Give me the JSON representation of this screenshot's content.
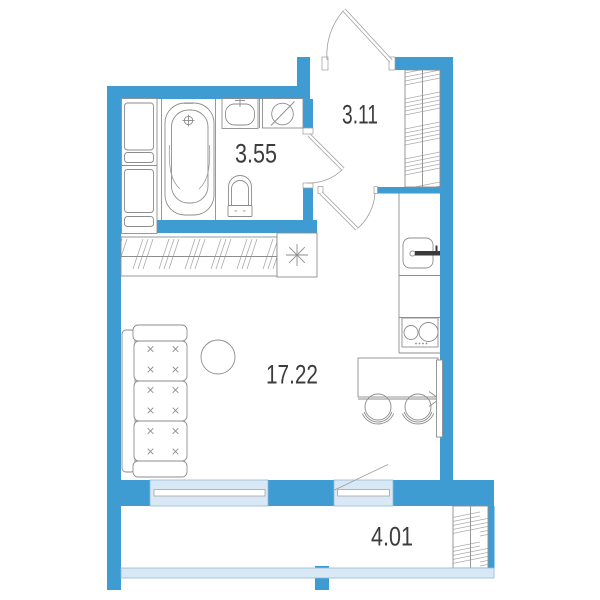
{
  "floor_plan": {
    "rooms": [
      {
        "name": "bathroom",
        "area_label": "3.55"
      },
      {
        "name": "hallway",
        "area_label": "3.11"
      },
      {
        "name": "living-room",
        "area_label": "17.22"
      },
      {
        "name": "balcony",
        "area_label": "4.01"
      }
    ],
    "colors": {
      "wall": "#3E9CD3",
      "glazing": "#D9E8F5",
      "outline": "#8D8D8D",
      "label_text": "#3C3C3C",
      "background": "#FFFFFF"
    },
    "fixtures": [
      "wardrobe",
      "bathtub",
      "bathroom-sink",
      "washing-machine",
      "toilet",
      "entrance-door",
      "bathroom-door",
      "living-room-door",
      "hall-closet",
      "kitchen-counter",
      "kitchen-sink",
      "cooktop",
      "dining-table",
      "chair",
      "radiator",
      "sofa",
      "round-table",
      "window",
      "balcony-door",
      "balcony-glazing",
      "balcony-hatch",
      "counter-unit",
      "vent-symbol"
    ]
  }
}
